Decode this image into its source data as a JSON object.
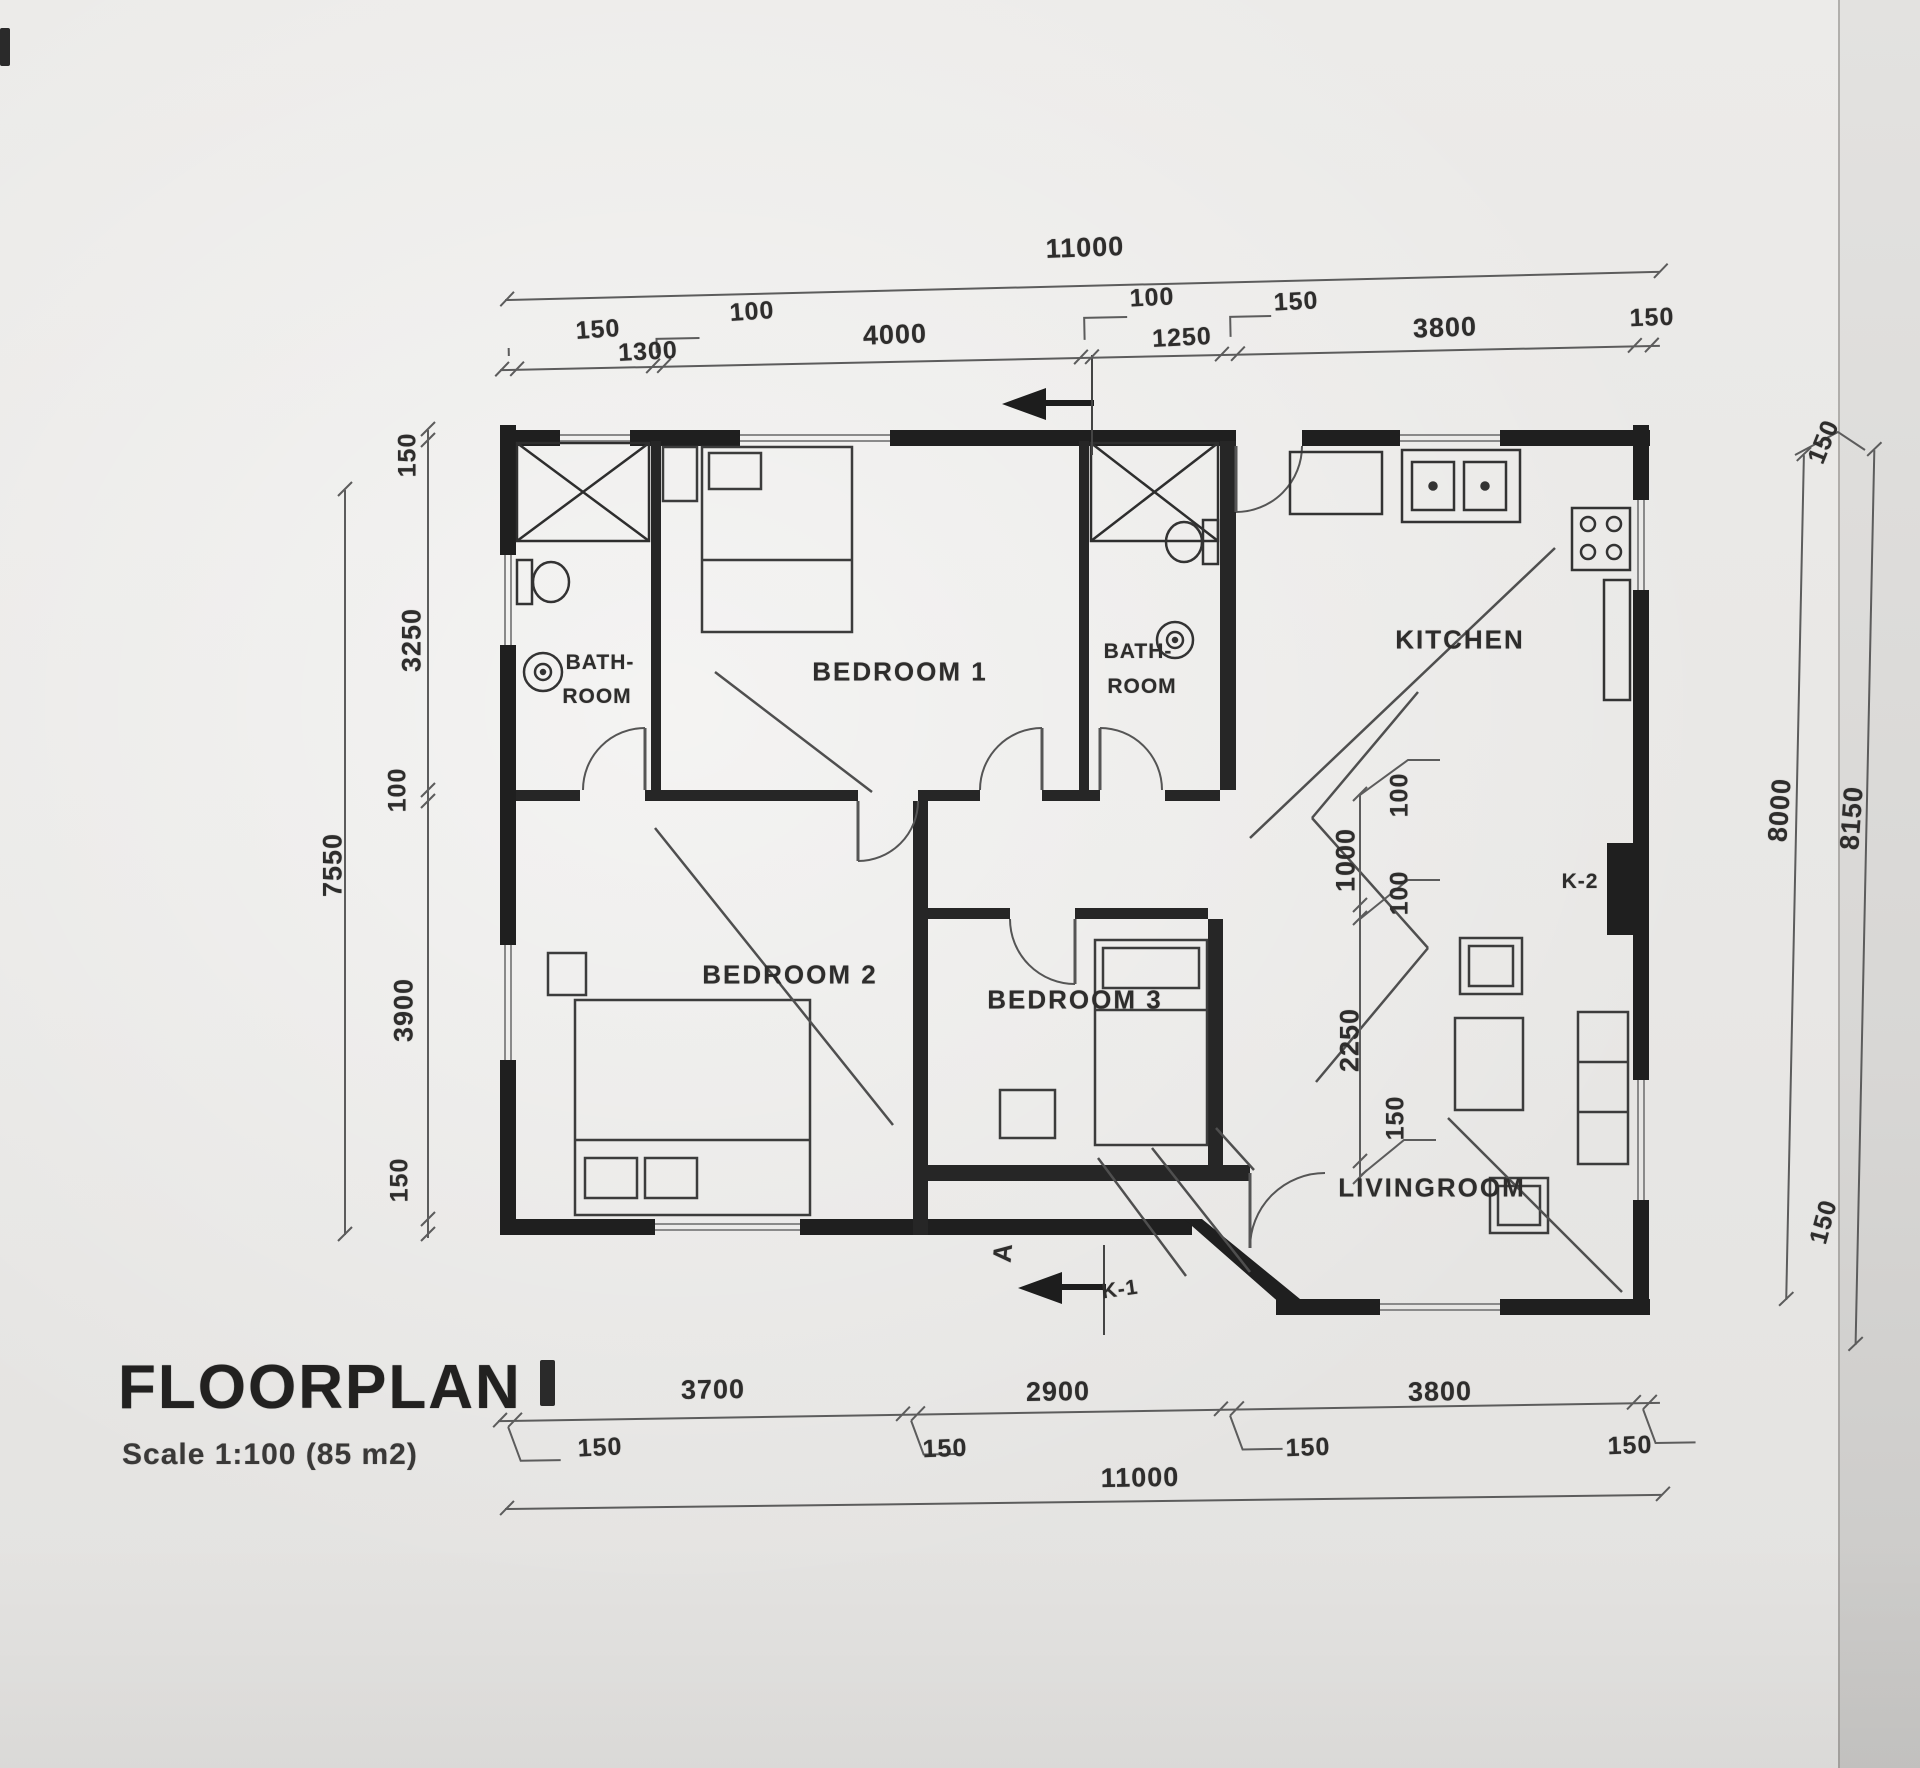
{
  "title": {
    "main": "FLOORPLAN",
    "scale_note": "Scale 1:100 (85 m2)"
  },
  "rooms": {
    "bathroom_left_line1": "BATH-",
    "bathroom_left_line2": "ROOM",
    "bedroom1": "BEDROOM 1",
    "bathroom_right_line1": "BATH-",
    "bathroom_right_line2": "ROOM",
    "kitchen": "KITCHEN",
    "bedroom2": "BEDROOM 2",
    "bedroom3": "BEDROOM 3",
    "livingroom": "LIVINGROOM",
    "k1": "K-1",
    "k2": "K-2"
  },
  "markers": {
    "section_letter": "A"
  },
  "dims": {
    "top_overall": "11000",
    "top_chain": [
      "150",
      "1300",
      "100",
      "4000",
      "100",
      "1250",
      "150",
      "3800",
      "150"
    ],
    "left_overall": "7550",
    "left_chain": [
      "150",
      "3250",
      "100",
      "3900",
      "150"
    ],
    "right_chain": [
      "150",
      "8000",
      "8150",
      "150"
    ],
    "interior_chain": [
      "100",
      "1000",
      "100",
      "2250",
      "150"
    ],
    "bottom_chain": [
      "150",
      "3700",
      "150",
      "2900",
      "150",
      "3800",
      "150"
    ],
    "bottom_overall": "11000"
  }
}
